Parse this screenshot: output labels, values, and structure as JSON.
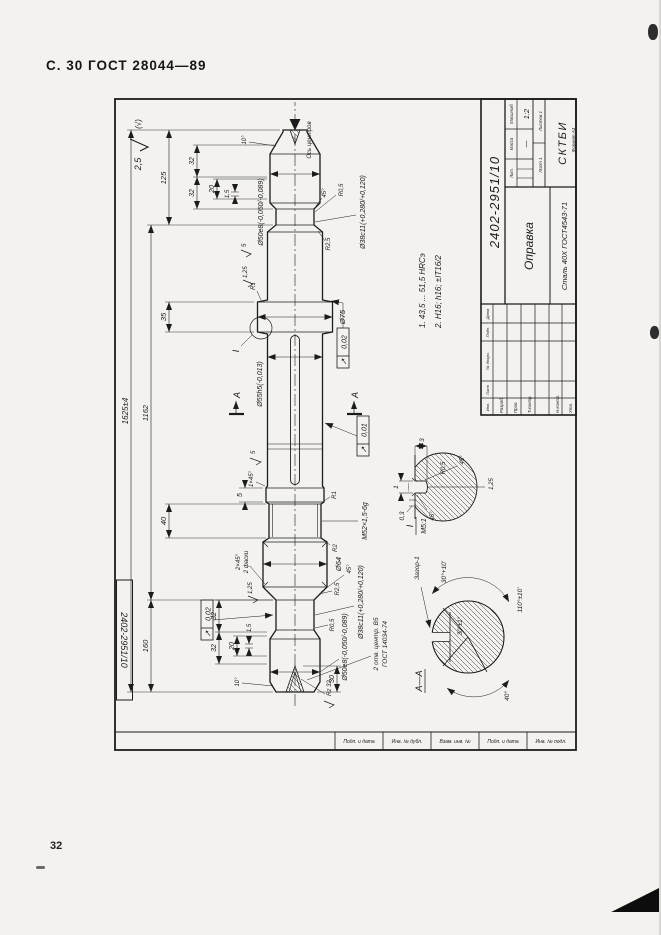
{
  "page": {
    "header": "С. 30 ГОСТ 28044—89",
    "page_number": "32"
  },
  "stamp": {
    "designation": "2402-2951/10",
    "designation_repeat": "2402-2951/10",
    "title": "Оправка",
    "material": "Сталь 40Х ГОСТ4543-71",
    "org": "СКТБИ",
    "scale": "1:2",
    "mass": "—",
    "lit_label": "Лит.",
    "mass_label": "Масса",
    "scale_label": "Масштаб",
    "sheet": "Лист 1",
    "sheets": "Листов 1",
    "format": "Формат А3",
    "sig_cols": [
      "Изм.",
      "Лист",
      "№ докум.",
      "Подп.",
      "Дата"
    ],
    "sig_rows": [
      "Разраб.",
      "Пров.",
      "Т.контр.",
      "Н.контр.",
      "Утв."
    ]
  },
  "margins": {
    "stamps": [
      "Подп. и дата",
      "Инв. № дубл.",
      "Взам. инв. №",
      "Подп. и дата",
      "Инв. № подл."
    ]
  },
  "notes": {
    "n1": "1. 43,5 ... 51,5 HRCэ",
    "n2": "2. Н16; h16; ±IT16/2"
  },
  "roughness": {
    "general": "2,5",
    "general_suffix": "(√)",
    "r5a": "5",
    "r5b": "5",
    "r125a": "1,25",
    "r125b": "1,25",
    "rz32": "Rz 32"
  },
  "dims": {
    "overall": "1625±4",
    "body": "1162",
    "left_len": "160",
    "right_len": "125",
    "m52_len": "40",
    "collar_w": "35",
    "r32a": "32",
    "r32b": "32",
    "r20": "20",
    "r15": "1,5",
    "l32a": "32",
    "l32b": "32",
    "l20": "20",
    "l15": "1,5",
    "l30": "30",
    "g5": "5",
    "d50r": "Ø50е8(-0,050/-0,089)",
    "d50l": "Ø50е8(-0,050/-0,089)",
    "d55": "Ø55h5(-0,013)",
    "d75": "Ø75",
    "d64": "Ø64",
    "d38r": "Ø38с11(+0,280/+0,120)",
    "d38l": "Ø38с11(+0,280/+0,120)",
    "thread": "М52×1,5-6g",
    "r1a": "R1",
    "r1b": "R1",
    "r2": "R2",
    "r25a": "R2,5",
    "r25b": "R2,5",
    "r05a": "R0,5",
    "r05b": "R0,5",
    "ch1": "1×45°",
    "ch2": "2×45°",
    "ch2b": "2 фаски",
    "a45a": "45°",
    "a45b": "45°",
    "a10a": "10°",
    "a10b": "10°",
    "axis": "Ось центров",
    "centers1": "2 отв. центр. В5",
    "centers2": "ГОСТ 14034-74",
    "tol1": "0,02",
    "tol2": "0,01",
    "tol3": "0,02",
    "runout_symbol": "↗",
    "secA": "А"
  },
  "detail": {
    "callout": "I",
    "title": "I",
    "scale": "М5:1",
    "w": "1",
    "depth": "3",
    "step": "0,3",
    "a45a": "45°",
    "a45b": "45°",
    "r": "R0,5",
    "rough": "1,25"
  },
  "section": {
    "title": "А—А",
    "gap": "Зазор-1",
    "flat": "30°±1°",
    "a_top": "30°+10'",
    "a_bot": "110°±10'",
    "a_left": "40°"
  }
}
